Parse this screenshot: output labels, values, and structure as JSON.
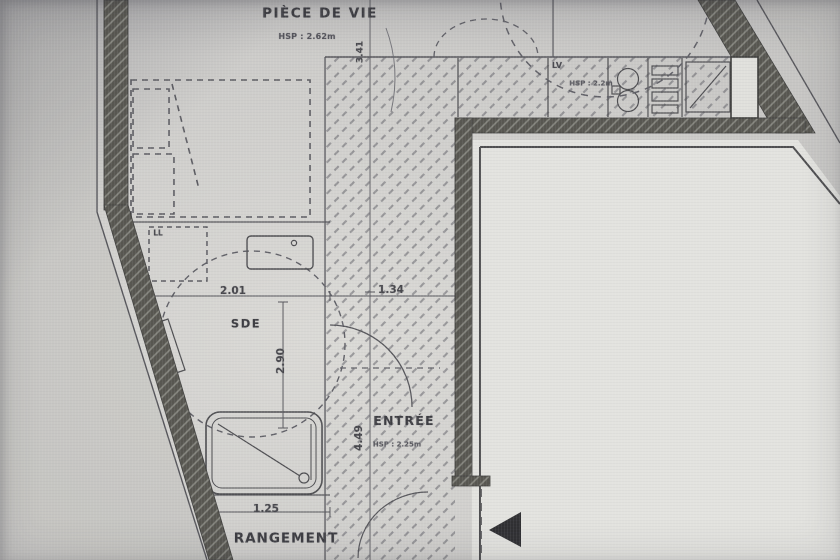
{
  "theme": {
    "paper": "#d7d6d2",
    "landing": "#e6e6e2",
    "ink": "#46464a",
    "wall": "#56554f",
    "text": "#3d3d42"
  },
  "plan": {
    "rooms": {
      "piece_de_vie": {
        "name": "PIÈCE DE VIE",
        "hsp": "HSP : 2.62m"
      },
      "sde": {
        "name": "SDE"
      },
      "entree": {
        "name": "ENTRÉE",
        "hsp": "HSP : 2.25m"
      },
      "rangement": {
        "name": "RANGEMENT"
      },
      "kitchen": {
        "lv_label": "LV",
        "hsp": "HSP : 2.2m"
      },
      "laundry": {
        "ll_label": "LL"
      }
    },
    "dimensions": {
      "living_width": "3.41",
      "sde_width": "2.01",
      "corridor_width": "1.34",
      "sde_depth": "2.90",
      "entree_depth": "4.49",
      "rangement_width": "1.25"
    }
  }
}
